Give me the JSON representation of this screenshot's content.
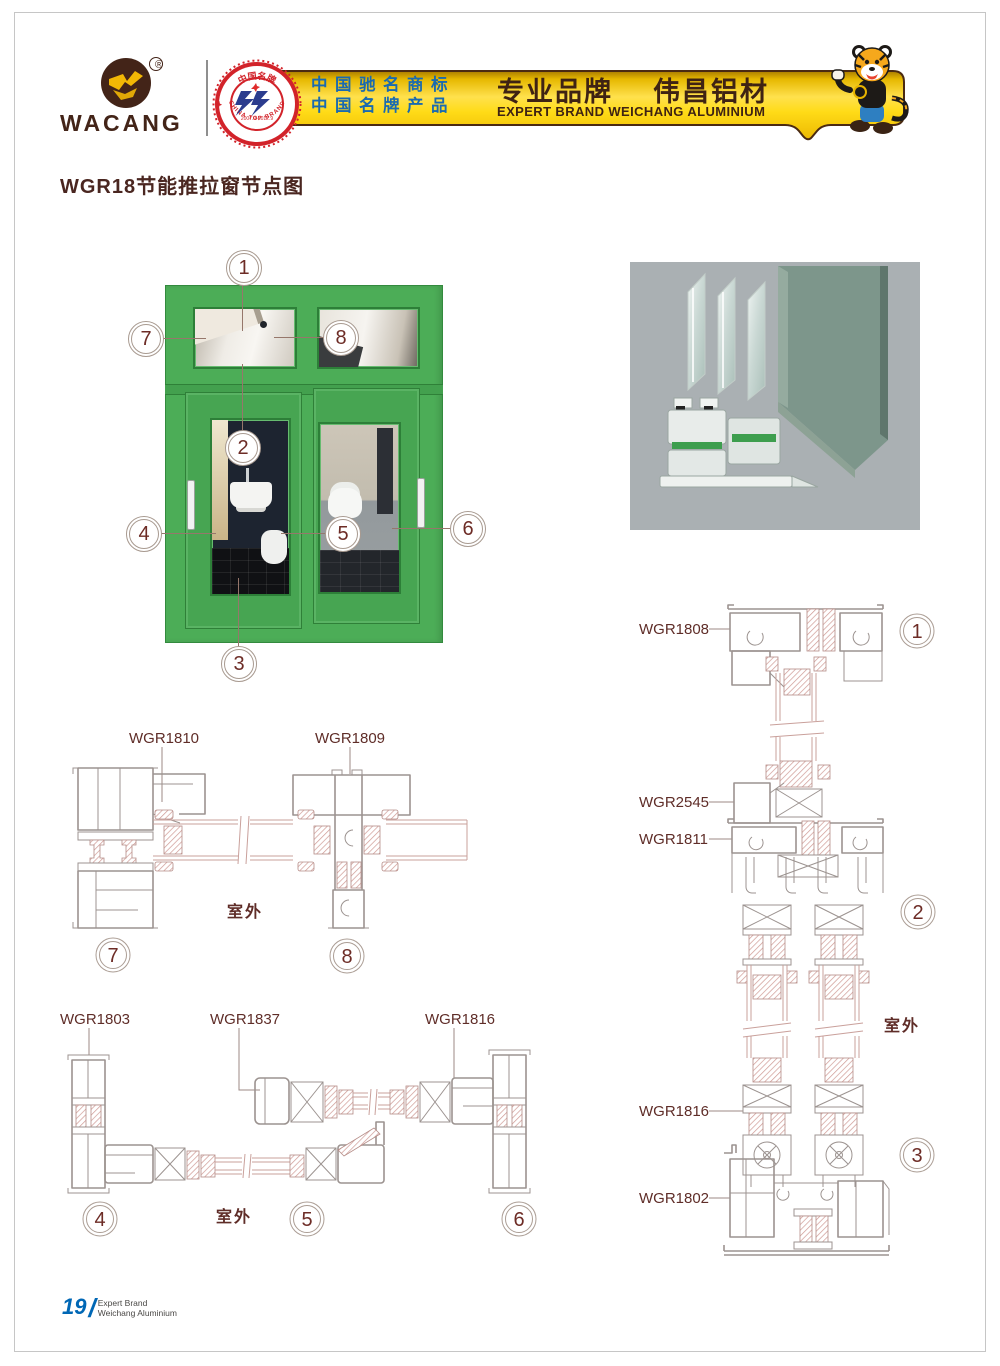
{
  "header": {
    "brand": "WACANG",
    "registered_mark": "®",
    "badge": {
      "top": "中国名牌",
      "bottom": "CHINA TOP BRAND",
      "years": "2007.9-2012.9"
    },
    "banner": {
      "cn_line1": "中国驰名商标",
      "cn_line2": "中国名牌产品",
      "slogan_left": "专业品牌",
      "slogan_right": "伟昌铝材",
      "slogan_en": "EXPERT BRAND WEICHANG ALUMINIUM"
    }
  },
  "title": "WGR18节能推拉窗节点图",
  "window": {
    "callouts": [
      "1",
      "2",
      "3",
      "4",
      "5",
      "6",
      "7",
      "8"
    ]
  },
  "details": {
    "row78": {
      "outdoor": "室外",
      "d7": {
        "num": "7",
        "label": "WGR1810"
      },
      "d8": {
        "num": "8",
        "label": "WGR1809"
      }
    },
    "row456": {
      "outdoor": "室外",
      "d4": {
        "num": "4",
        "label": "WGR1803"
      },
      "d5": {
        "num": "5",
        "label": "WGR1837"
      },
      "d6": {
        "num": "6",
        "label": "WGR1816"
      }
    },
    "vertical": {
      "outdoor": "室外",
      "labels": {
        "l1": "WGR1808",
        "l2": "WGR2545",
        "l3": "WGR1811",
        "l4": "WGR1816",
        "l5": "WGR1802"
      },
      "n1": "1",
      "n2": "2",
      "n3": "3"
    }
  },
  "footer": {
    "page": "19",
    "slash": "/",
    "line1": "Expert Brand",
    "line2": "Weichang Aluminium"
  },
  "colors": {
    "brand_brown": "#432418",
    "gold": "#f7c600",
    "banner_blue": "#1a6ab0",
    "window_green": "#4cad57",
    "maroon": "#6d2c26",
    "line_gray": "#9c9390",
    "hatch_pink": "#cf9a94",
    "footer_blue": "#0067b5"
  }
}
